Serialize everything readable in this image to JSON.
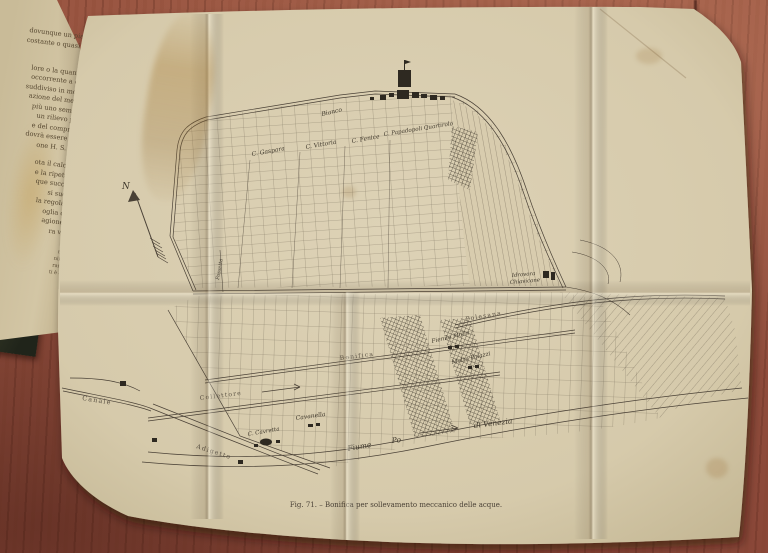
{
  "photo": {
    "caption": "Fig. 71. – Bonifica per sollevamento meccanico delle acque."
  },
  "book": {
    "lines": [
      "dovunque un piano",
      "costante o quasi), il",
      "re",
      "lore o la quantità",
      "occorrente a col-",
      "suddiviso in molte",
      "azione del medio",
      "più uno sempre",
      "un rilievo pla-",
      "e del compren-",
      "dovrà essere ba-",
      "one H. S. bal",
      "ota il calcolo",
      "e la ripetuta",
      "que succes-",
      "si suddi",
      "la regolare",
      "oglia dei",
      "agione e",
      "ra var"
    ],
    "footnotes": [
      "nel",
      "nimi",
      "rami",
      "ti è al"
    ]
  },
  "map": {
    "compass_n": "N",
    "labels": {
      "bianco": "Bianco",
      "gaspara": "C. Gaspara",
      "vittoria": "C. Vittoria",
      "fenice": "C. Fenice",
      "papadopoli": "C. Papadopoli Quartirolo",
      "fossetta": "Fossetta",
      "idrovora_line1": "Idrovora",
      "idrovora_line2": "Chiavicone",
      "polesana": "Polesana",
      "bonifica": "Bonifica",
      "collettore": "Collettore",
      "fienile": "Fienile Molin",
      "motta": "Motta Palazzi",
      "cavanella": "Cavanella",
      "cavretta": "C. Cavretta",
      "canale": "Canale",
      "adigetto": "Adigetto",
      "fiume": "Fiume",
      "po": "Po",
      "di_venezia": "di Venezia"
    }
  },
  "colors": {
    "wood": "#8d4a3a",
    "paper": "#d8ccae",
    "ink": "#4a4136"
  }
}
